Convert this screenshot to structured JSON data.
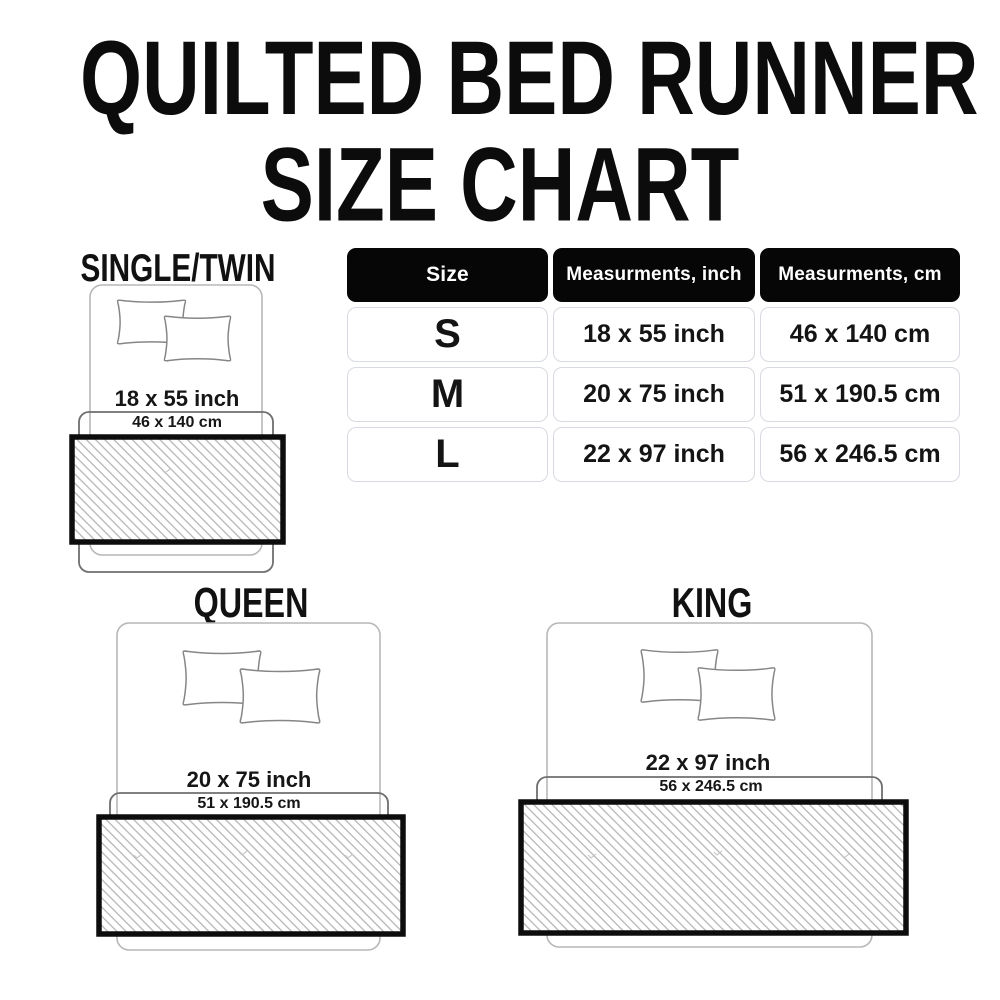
{
  "title": {
    "line1": "QUILTED BED RUNNER",
    "line2": "SIZE CHART"
  },
  "table": {
    "headers": [
      "Size",
      "Measurments, inch",
      "Measurments, cm"
    ],
    "rows": [
      {
        "size": "S",
        "inch": "18 x 55 inch",
        "cm": "46 x 140 cm"
      },
      {
        "size": "M",
        "inch": "20 x 75 inch",
        "cm": "51 x 190.5 cm"
      },
      {
        "size": "L",
        "inch": "22 x 97 inch",
        "cm": "56 x 246.5 cm"
      }
    ]
  },
  "diagrams": {
    "single": {
      "label": "SINGLE/TWIN",
      "inch": "18 x 55 inch",
      "cm": "46 x 140 cm"
    },
    "queen": {
      "label": "QUEEN",
      "inch": "20 x 75 inch",
      "cm": "51 x 190.5 cm"
    },
    "king": {
      "label": "KING",
      "inch": "22 x 97 inch",
      "cm": "56 x 246.5 cm"
    }
  },
  "colors": {
    "header_bg": "#060606",
    "cell_border": "#d7dae0",
    "runner_border": "#0d0d0d",
    "hatch_line": "#a9a9a9",
    "bed_outline": "#b7b7b7",
    "bracket_outline": "#6f6f6f"
  }
}
